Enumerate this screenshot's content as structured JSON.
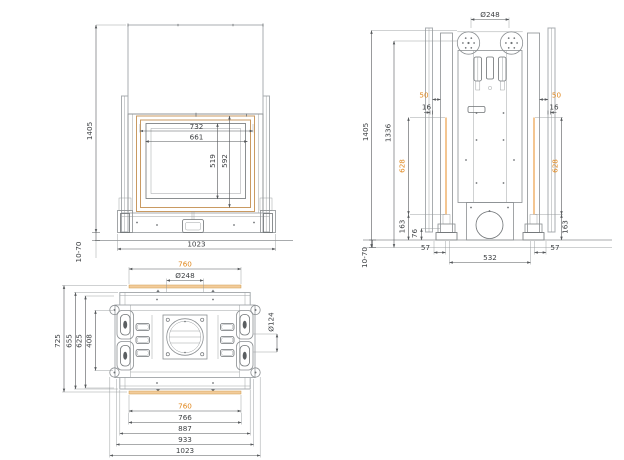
{
  "front_view": {
    "overall_height": "1405",
    "frame_width": "732",
    "glass_width": "661",
    "glass_height": "519",
    "frame_height": "592",
    "overall_width": "1023",
    "floor_gap": "10-70"
  },
  "side_view": {
    "flue_diameter": "Ø248",
    "overall_height": "1405",
    "frame_height": "1336",
    "wall_offset_left": "50",
    "wall_offset_right": "50",
    "gap_left": "16",
    "gap_right": "16",
    "rail_left": "628",
    "rail_right": "628",
    "base_left": "163",
    "base_right": "163",
    "duct_height": "76",
    "depth_front": "57",
    "body_depth": "532",
    "depth_rear": "57",
    "floor_gap": "10-70"
  },
  "top_view": {
    "gasket_width_top": "760",
    "flue_diameter": "Ø248",
    "overall_depth": "725",
    "plate_depth": "655",
    "inner_depth": "625",
    "latch_span": "408",
    "roller_diameter": "Ø124",
    "gasket_width_bottom": "760",
    "opening_width": "766",
    "plate_width": "887",
    "body_width": "933",
    "overall_width": "1023"
  },
  "colors": {
    "dimension_orange": "#e0861a",
    "frame_tan": "#c99a62",
    "line_gray": "#a9adb0",
    "dim_line": "#55585b",
    "background": "#ffffff"
  }
}
